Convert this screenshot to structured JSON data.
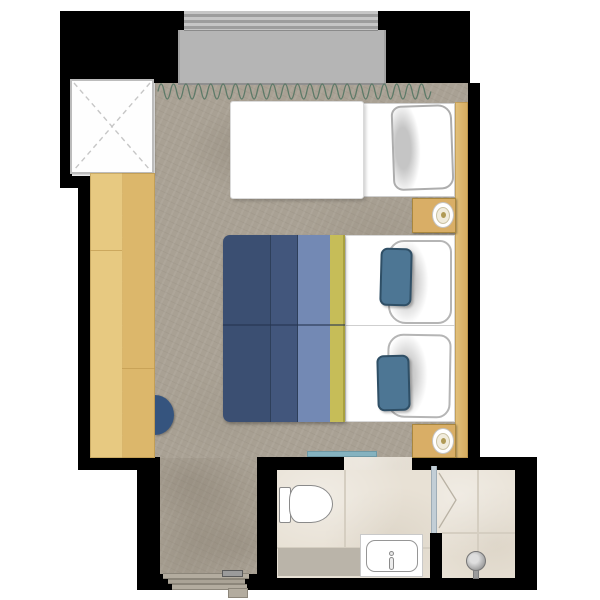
{
  "meta": {
    "description": "Top-down architectural floor plan of a hotel guest room: balcony with roller shutter at top, carpeted bedroom with double bed, daybed, desk and stool, entry corridor at bottom, bathroom with toilet and sink vanity, separate walk-in shower",
    "canvas": {
      "width": 600,
      "height": 600
    }
  },
  "palette": {
    "wall": "#000000",
    "balcony_floor": "#b5b5b5",
    "carpet": "#a9a194",
    "tile": "#e8e1d5",
    "grout": "#d5cec1",
    "mat": "#bab4a9",
    "wood_desk": "#e0bd74",
    "wood_panel": "#ddba72",
    "nightstand": "#d9ae66",
    "shaft_fill": "#fefefe",
    "shaft_dash": "#c6c6c6",
    "curtain": "#5d7a68",
    "chair": "#35547e",
    "sheet_white": "#ffffff",
    "duvet_dark": "#3b4f72",
    "duvet_mid": "#42567c",
    "duvet_slate": "#7389b4",
    "duvet_yellow": "#c6bd58",
    "pillow_blue": "#4d7694",
    "pillow_trim": "#b5b5b5",
    "teal_door": "#85b2bf",
    "glass": "#c2ced6",
    "fixture_line": "#8a8a8a",
    "metal": "#9b9b9b",
    "swing_line": "#b9b2a4"
  },
  "rooms": {
    "balcony": "balcony",
    "bedroom": "bedroom",
    "entry": "entry corridor",
    "bathroom": "bathroom",
    "shower": "walk-in shower"
  },
  "furniture": [
    "roller-shutter",
    "balcony-floor",
    "shaft-cross-box",
    "curtain-line",
    "desk-sideboard",
    "stool",
    "daybed",
    "daybed-pillow",
    "double-bed",
    "duvet",
    "white-pillows",
    "blue-accent-pillows",
    "nightstand-with-lamp-upper",
    "nightstand-with-lamp-lower",
    "headboard-panel",
    "entry-door-threshold",
    "sliding-bathroom-door",
    "toilet",
    "sink-vanity",
    "bath-mat",
    "glass-partition",
    "shower-door-swing",
    "shower-head"
  ]
}
